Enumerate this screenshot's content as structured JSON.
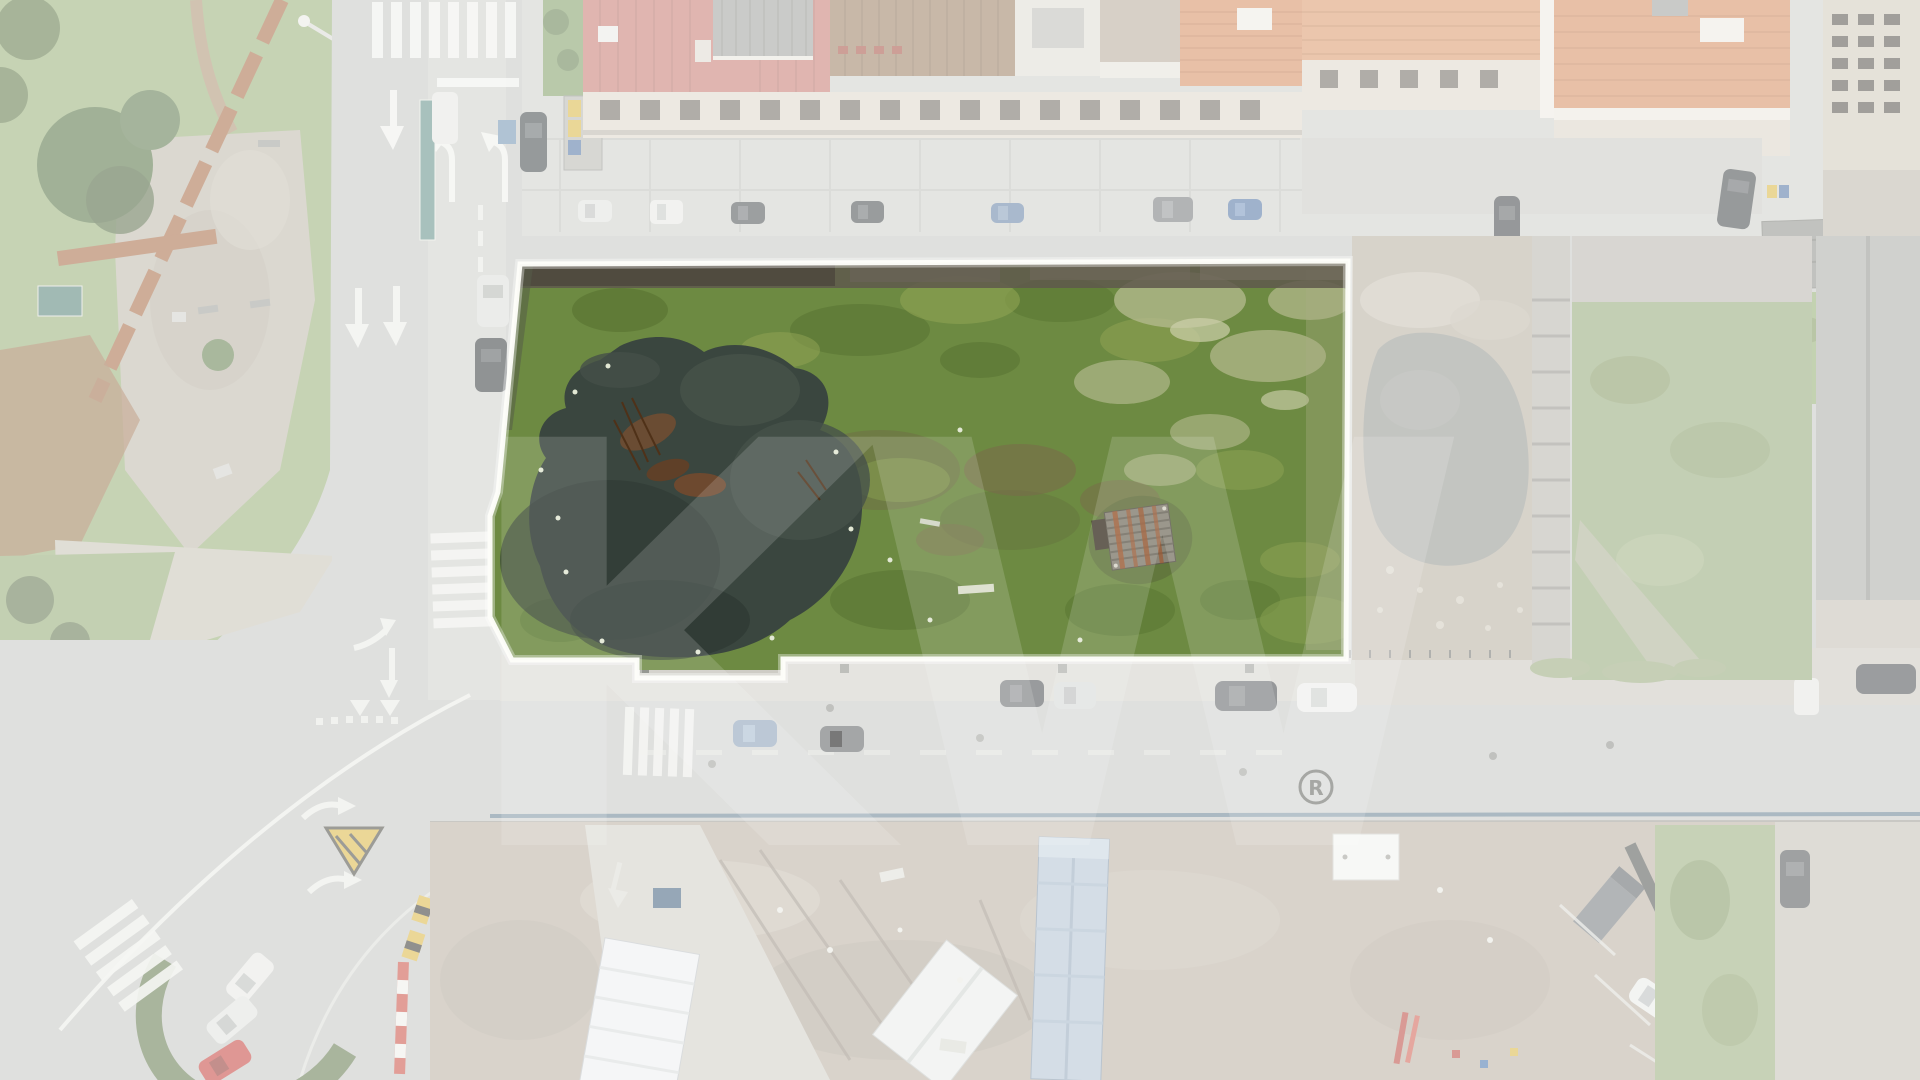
{
  "watermark": {
    "letters": "KW",
    "registered_r": "R"
  },
  "road_markings": {
    "stop_text": "S"
  },
  "palette": {
    "plot_boundary": "#fdfdf9",
    "fade_white": "#ffffff",
    "plot_grass": "#6d8a42",
    "pond": "#3a463f",
    "asphalt": "#c3c5c1",
    "sidewalk": "#cfd0ca",
    "park_green": "#93ad72",
    "construction_dirt": "#b7ad9e",
    "red_roof": "#c4746a",
    "orange_roof": "#d3885a",
    "brown_roof": "#97795c",
    "warehouse_blue_roof": "#aebfd0",
    "water_pipe_blue": "#567488",
    "right_pond_grey": "#8f918b",
    "lawn_green": "#95ab77",
    "hedge_green": "#5e7347",
    "red_car": "#c23b35",
    "safety_yellow": "#d9b33c",
    "rust_wall": "#a2643e"
  }
}
